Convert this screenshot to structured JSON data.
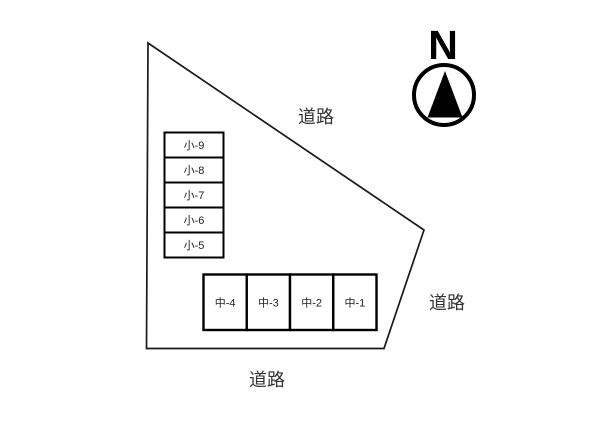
{
  "diagram": {
    "type": "site-plan",
    "background_color": "#ffffff",
    "line_color": "#1a1a1a",
    "text_color": "#333333"
  },
  "compass": {
    "north_label": "N"
  },
  "roads": {
    "top_label": "道路",
    "right_label": "道路",
    "bottom_label": "道路"
  },
  "parking": {
    "small_spaces": [
      {
        "label": "小-9"
      },
      {
        "label": "小-8"
      },
      {
        "label": "小-7"
      },
      {
        "label": "小-6"
      },
      {
        "label": "小-5"
      }
    ],
    "medium_spaces": [
      {
        "label": "中-4"
      },
      {
        "label": "中-3"
      },
      {
        "label": "中-2"
      },
      {
        "label": "中-1"
      }
    ]
  }
}
